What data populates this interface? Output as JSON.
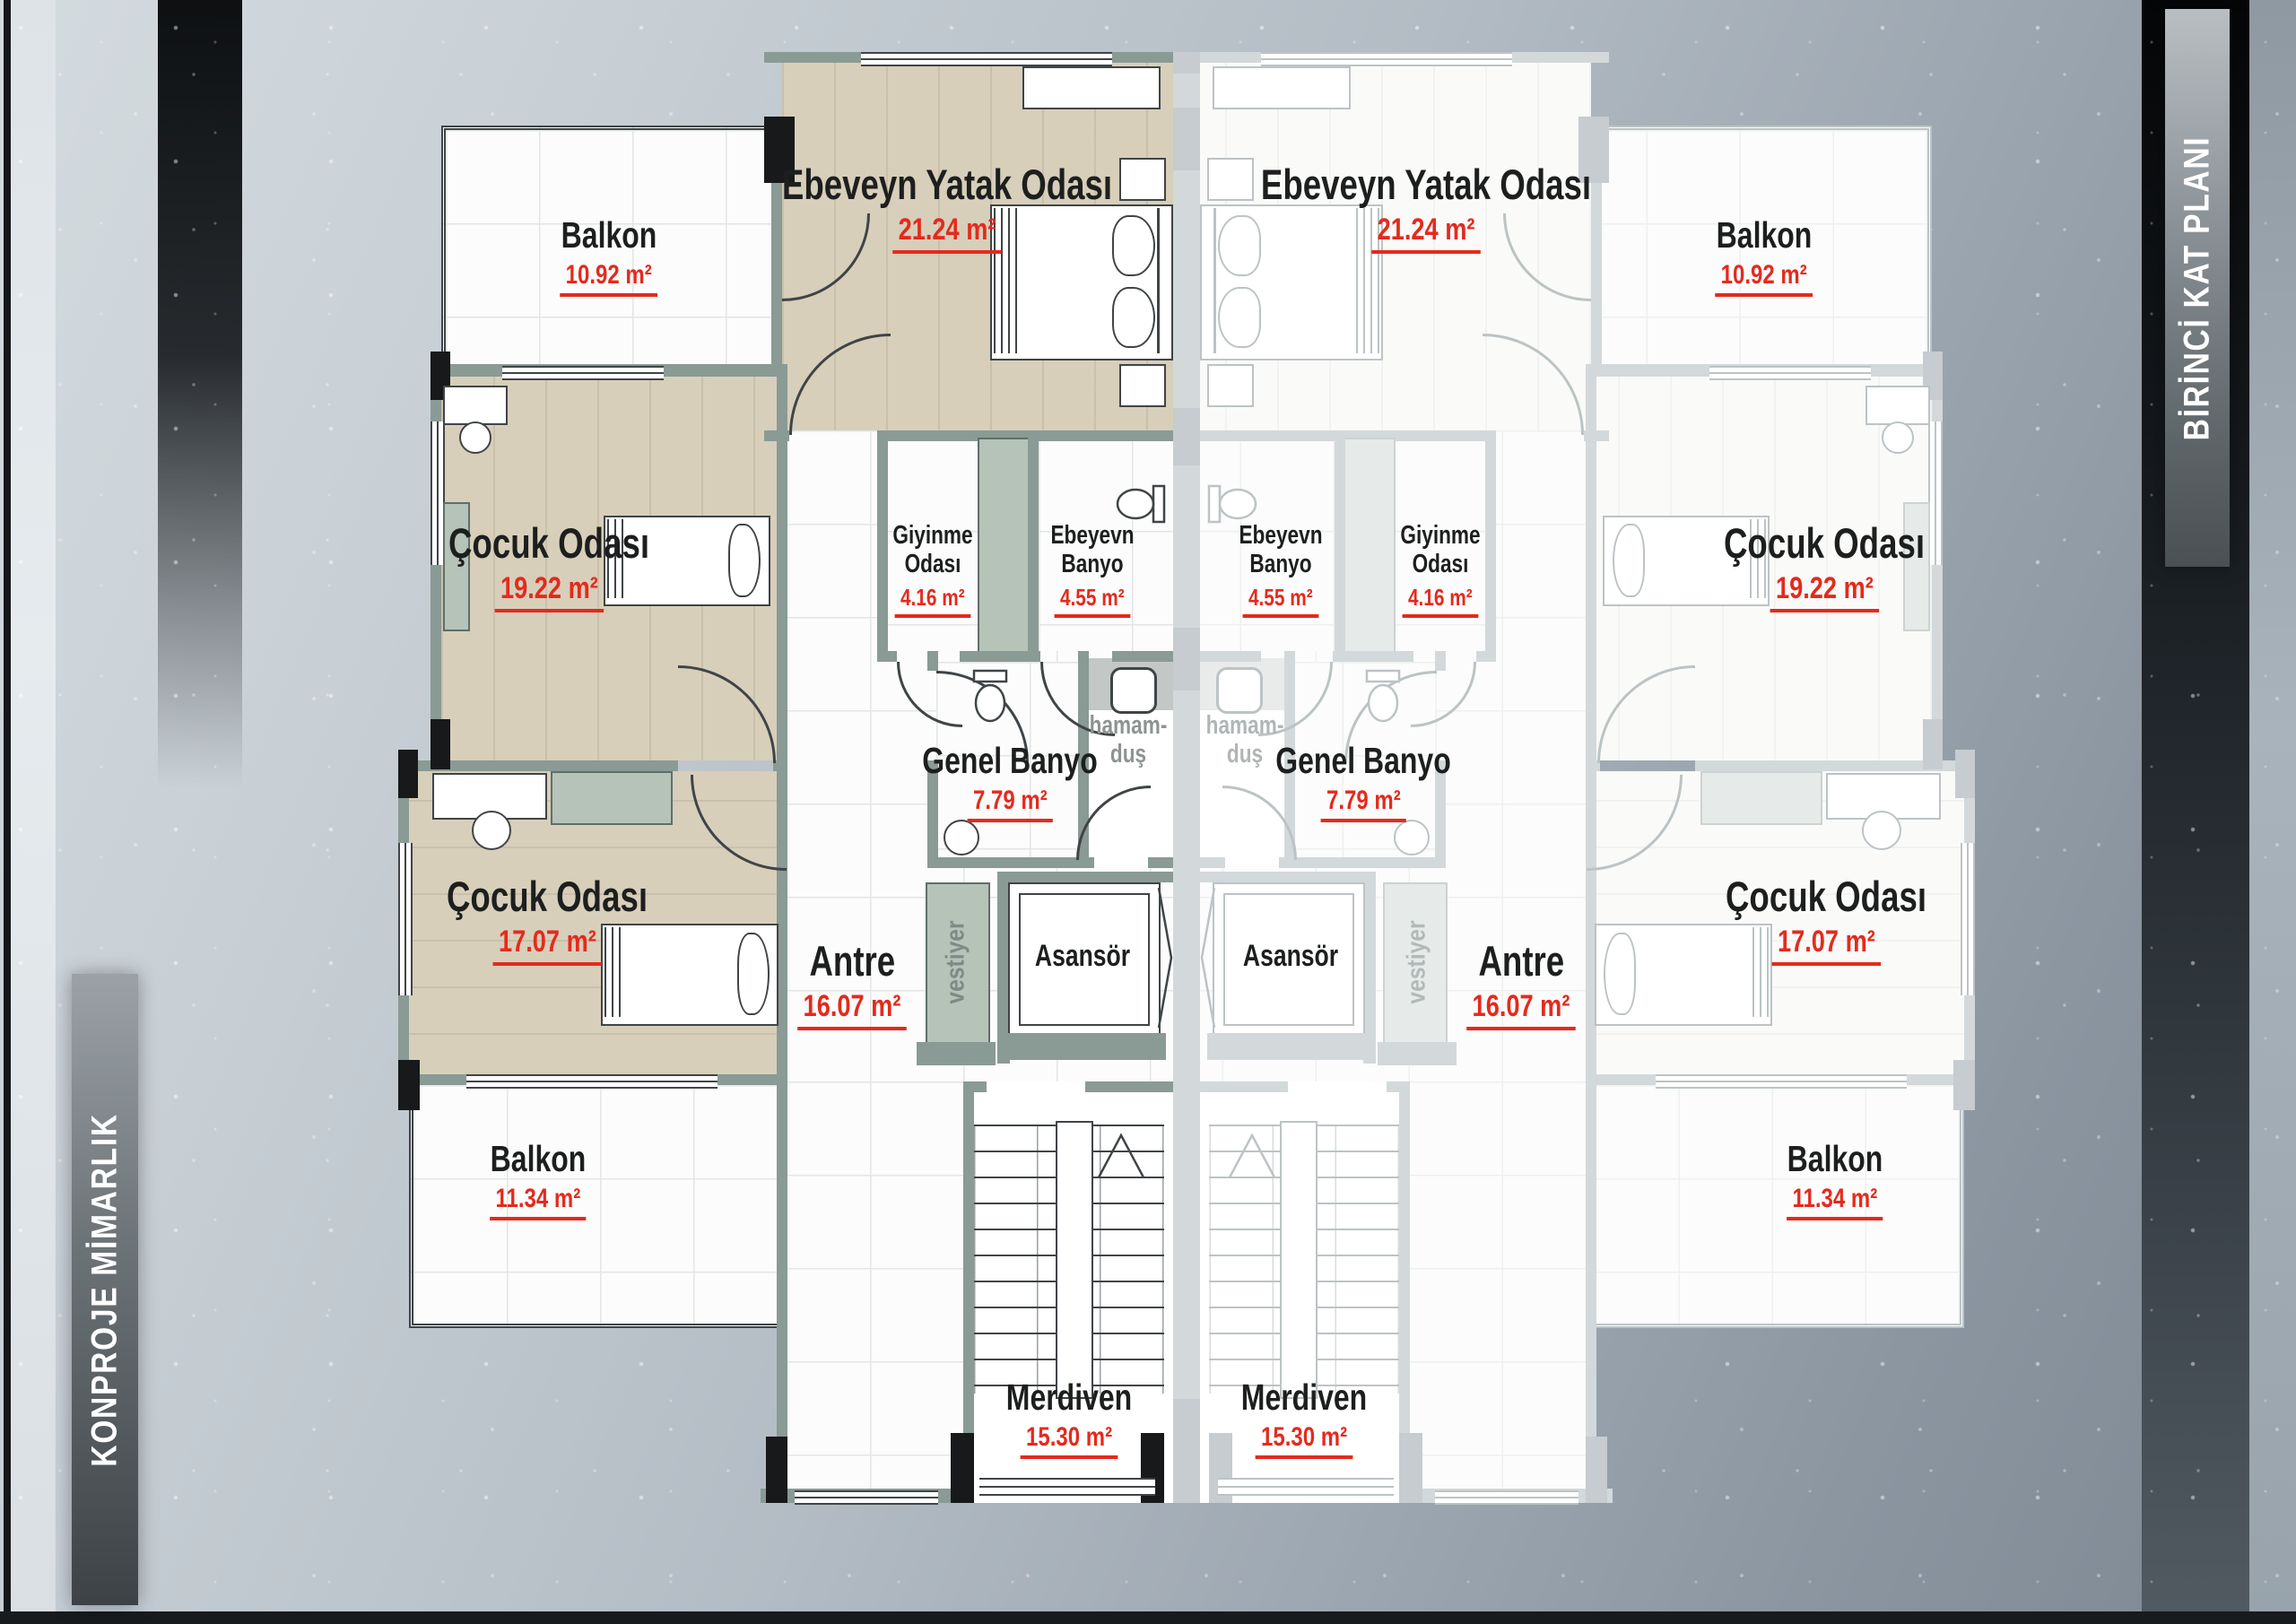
{
  "sidebars": {
    "left": {
      "text": "KONPROJE MİMARLIK"
    },
    "right": {
      "text": "BİRİNCİ KAT PLANI"
    }
  },
  "rooms": {
    "balkon_top": {
      "label": "Balkon",
      "area": "10.92  m²"
    },
    "ebeveyn": {
      "label": "Ebeveyn Yatak Odası",
      "area": "21.24  m²"
    },
    "cocuk_ust": {
      "label": "Çocuk Odası",
      "area": "19.22  m²"
    },
    "giyinme": {
      "label": "Giyinme Odası",
      "area": "4.16  m²"
    },
    "ebeveyn_banyo": {
      "label": "Ebeyevn Banyo",
      "area": "4.55  m²"
    },
    "genel_banyo": {
      "label": "Genel Banyo",
      "area": "7.79 m²"
    },
    "hamam": {
      "label": "hamam-duş"
    },
    "cocuk_alt": {
      "label": "Çocuk Odası",
      "area": "17.07  m²"
    },
    "antre": {
      "label": "Antre",
      "area": "16.07  m²"
    },
    "vestiyer": {
      "label": "vestiyer"
    },
    "asansor": {
      "label": "Asansör"
    },
    "balkon_alt": {
      "label": "Balkon",
      "area": "11.34  m²"
    },
    "merdiven": {
      "label": "Merdiven",
      "area": "15.30 m²"
    }
  },
  "colors": {
    "accent_red": "#e42a1d",
    "wall_green": "#8a9a95",
    "column_black": "#17191a",
    "wood_floor": "#d7cfba",
    "ghost_wall": "#d3d9da"
  }
}
